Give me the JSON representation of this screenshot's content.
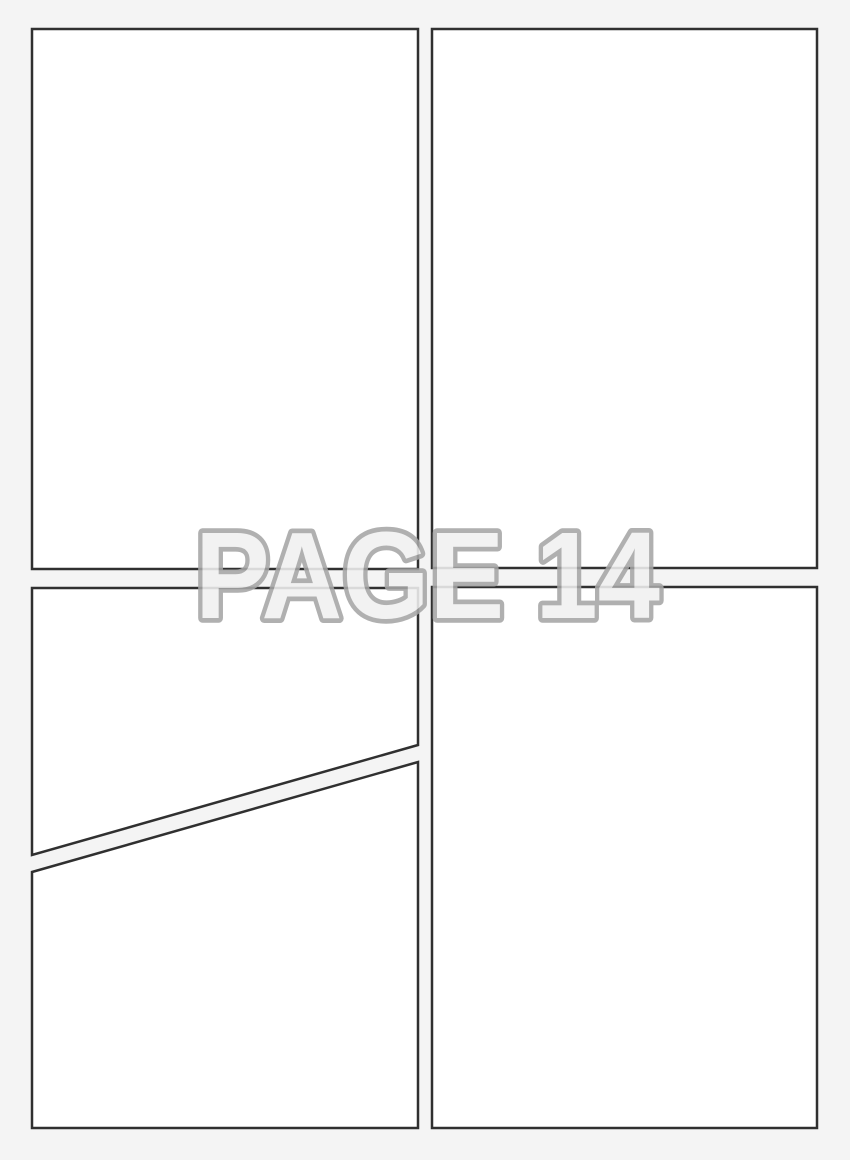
{
  "page": {
    "type": "blank-comic-page-template",
    "panel_count": 5
  },
  "watermark": {
    "text": "PAGE 14"
  },
  "panels": [
    {
      "id": "top-left",
      "shape": "rectangle"
    },
    {
      "id": "top-right",
      "shape": "rectangle"
    },
    {
      "id": "bottom-left-upper",
      "shape": "polygon-diagonal-bottom"
    },
    {
      "id": "bottom-left-lower",
      "shape": "polygon-diagonal-top"
    },
    {
      "id": "bottom-right",
      "shape": "rectangle"
    }
  ],
  "colors": {
    "page_background": "#f4f4f4",
    "panel_fill": "#ffffff",
    "panel_border": "#303030",
    "watermark_outline": "#a6a6a6",
    "watermark_fill": "#f1f1f1"
  }
}
